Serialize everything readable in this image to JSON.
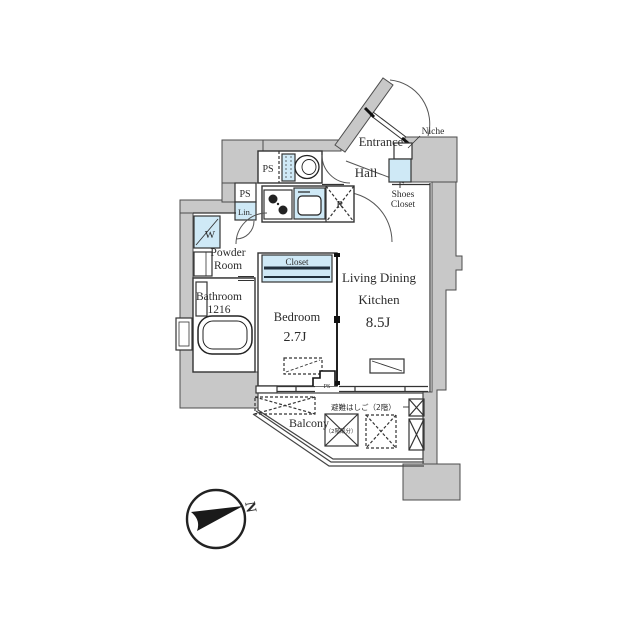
{
  "colors": {
    "wall_gray": "#c8c8c8",
    "fixture_blue": "#cfe9f6",
    "line_dark": "#333333",
    "background": "#ffffff"
  },
  "plan": {
    "entrance": "Entrance",
    "hall": "Hall",
    "niche": "Niche",
    "shoes_closet": [
      "Shoes",
      "Closet"
    ],
    "ps": "PS",
    "lin": "Lin.",
    "washer": "W",
    "fridge": "R",
    "powder_room": [
      "Powder",
      "Room"
    ],
    "bathroom": [
      "Bathroom",
      "1216"
    ],
    "closet": "Closet",
    "bedroom": [
      "Bedroom",
      "2.7J"
    ],
    "ldk": [
      "Living Dining",
      "Kitchen",
      "8.5J"
    ],
    "balcony": "Balcony",
    "evacuation_ladder": "避難はしご（2階）",
    "second_floor_part": "（2階部分）"
  },
  "compass": {
    "north": "N"
  }
}
